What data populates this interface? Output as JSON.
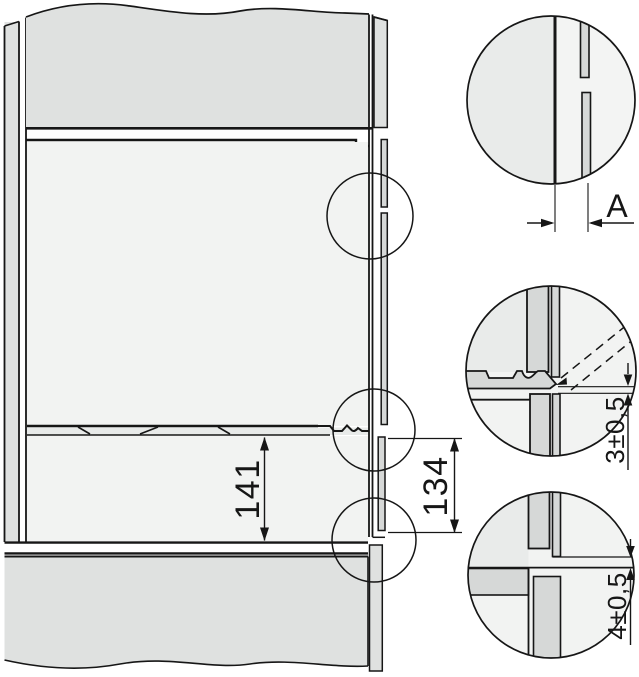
{
  "drawing": {
    "title": "appliance-niche-installation-side-section",
    "dimensions": {
      "niche_height": "141",
      "front_cutout_height": "134",
      "front_overhang_label": "A",
      "upper_gap": "3±0,5",
      "lower_gap": "4±0,5"
    },
    "colors": {
      "line": "#161616",
      "panel": "#dfe1e0",
      "light": "#f2f3f2",
      "strip": "#d6d8d7",
      "band": "#e8eae9",
      "field": "#e9ebea",
      "bg": "#ffffff"
    }
  }
}
